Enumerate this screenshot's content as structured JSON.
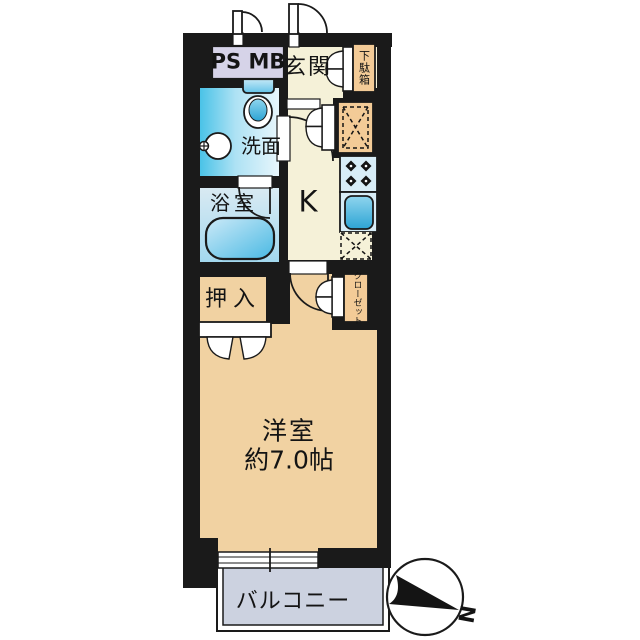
{
  "labels": {
    "psmb": "PS MB",
    "genkan": "玄関",
    "getabako": "下駄箱",
    "senmen": "洗面",
    "yokushitsu": "浴室",
    "kitchen": "K",
    "oshiire": "押入",
    "closet": "クローゼット",
    "main_room": "洋室",
    "main_room_size": "約7.0帖",
    "balcony": "バルコニー",
    "compass_north": "N"
  },
  "colors": {
    "wall": "#1a1a1a",
    "tan": "#f1d2a2",
    "cream": "#f5f1d8",
    "orange": "#f3cb97",
    "lavender": "#d6d3e8",
    "balcony": "#ccd2e0",
    "fixture": "#d8edf7",
    "wet": "#45c2e6"
  }
}
